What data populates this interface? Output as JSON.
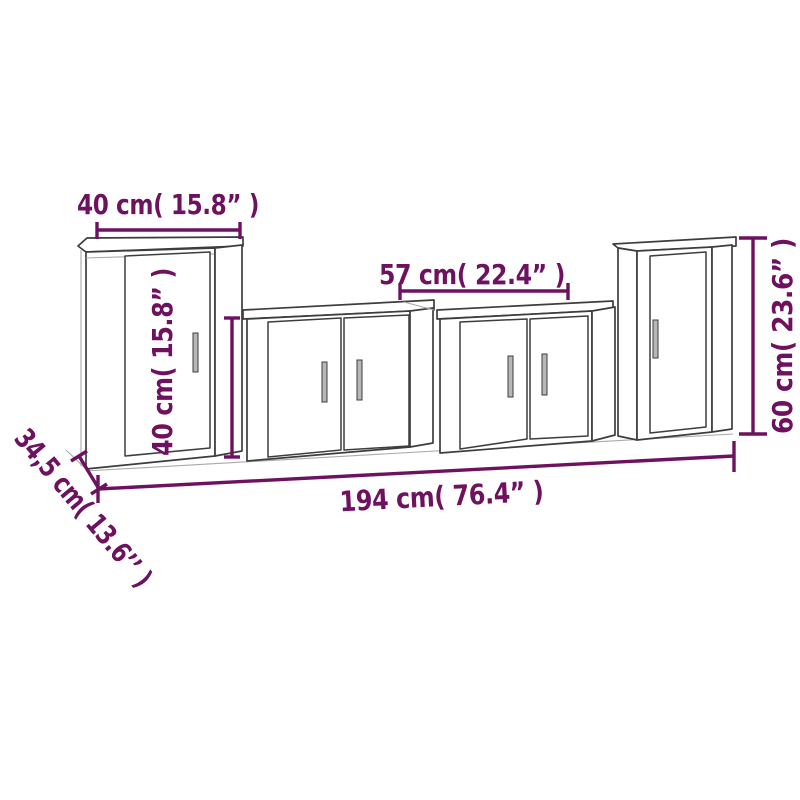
{
  "diagram": {
    "description": "4-piece TV cabinet wall set dimension drawing",
    "colors": {
      "dimension": "#6E1260",
      "outline": "#3d3d3d",
      "light_outline": "#a9a9a9",
      "handle_fill": "#b8b8b8",
      "background": "#ffffff"
    },
    "labels": {
      "top_width": "40 cm( 15.8” )",
      "inner_width": "57 cm( 22.4” )",
      "small_cabinet_height": "40 cm( 15.8” )",
      "large_cabinet_height": "60 cm( 23.6” )",
      "total_width": "194 cm( 76.4” )",
      "depth": "34,5 cm( 13.6’’ )"
    }
  }
}
